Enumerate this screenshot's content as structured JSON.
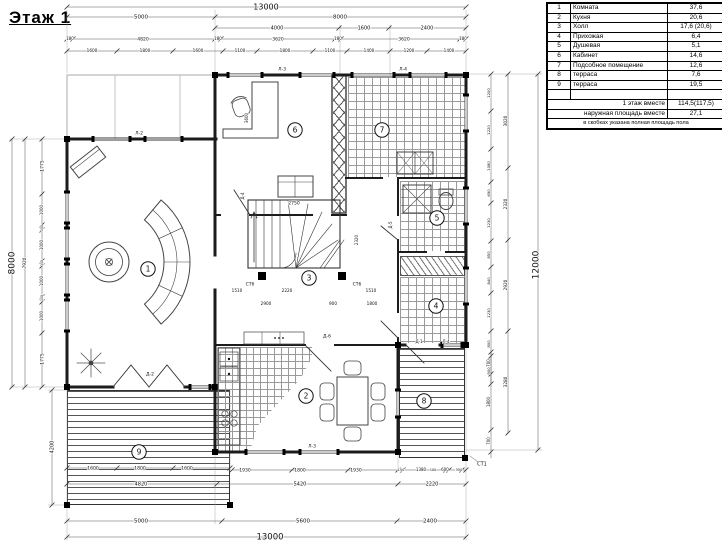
{
  "title": "Этаж 1",
  "legend": {
    "rows": [
      {
        "num": "1",
        "name": "Комната",
        "area": "37,6"
      },
      {
        "num": "2",
        "name": "Кухня",
        "area": "20,6"
      },
      {
        "num": "3",
        "name": "Холл",
        "area": "17,6 (20,6)"
      },
      {
        "num": "4",
        "name": "Прихожая",
        "area": "6,4"
      },
      {
        "num": "5",
        "name": "Душевая",
        "area": "5,1"
      },
      {
        "num": "6",
        "name": "Кабинет",
        "area": "14,6"
      },
      {
        "num": "7",
        "name": "Подсобное помещение",
        "area": "12,6"
      },
      {
        "num": "8",
        "name": "терраса",
        "area": "7,6"
      },
      {
        "num": "9",
        "name": "терраса",
        "area": "19,5"
      }
    ],
    "summary": [
      {
        "label": "1 этаж вместе",
        "value": "114,5(117,5)"
      },
      {
        "label": "наружная площадь вместе",
        "value": "27,1"
      }
    ],
    "note": "в скобках указана полная площадь пола"
  },
  "rooms": [
    {
      "num": "1",
      "name": "Комната"
    },
    {
      "num": "2",
      "name": "Кухня"
    },
    {
      "num": "3",
      "name": "Холл"
    },
    {
      "num": "4",
      "name": "Прихожая"
    },
    {
      "num": "5",
      "name": "Душевая"
    },
    {
      "num": "6",
      "name": "Кабинет"
    },
    {
      "num": "7",
      "name": "Подсобное помещение"
    },
    {
      "num": "8",
      "name": "терраса"
    },
    {
      "num": "9",
      "name": "терраса"
    }
  ],
  "dimensions": {
    "top": {
      "row1": "13000",
      "row2": [
        "5000",
        "8000"
      ],
      "row3": [
        "4000",
        "1600",
        "2400"
      ],
      "row4": [
        "180",
        "4820",
        "180",
        "3620",
        "180",
        "3620",
        "180"
      ],
      "row5": [
        "1600",
        "1800",
        "1600",
        "1100",
        "1800",
        "1100",
        "1400",
        "1200",
        "1400"
      ]
    },
    "bottom": {
      "row1": [
        "1600",
        "1800",
        "1600",
        "1930",
        "1800",
        "1930",
        "150",
        "1380",
        "100",
        "600",
        "350"
      ],
      "row2": [
        "4820",
        "5420",
        "2220"
      ],
      "row3": [
        "5000",
        "5600",
        "2400"
      ],
      "row4": "13000"
    },
    "left": {
      "overall": "8000",
      "inner": "7920",
      "chain": [
        "1775",
        "1000",
        "150",
        "1000",
        "150",
        "1000",
        "150",
        "1000",
        "1775"
      ],
      "terrace": "4200"
    },
    "right": {
      "overall": "12000",
      "mid": [
        "3020",
        "2320",
        "2920",
        "3280"
      ],
      "chain": [
        "1200",
        "1220",
        "1080",
        "690",
        "1230",
        "850",
        "840",
        "1230",
        "800",
        "900"
      ],
      "terrace": [
        "700",
        "1800",
        "700"
      ]
    },
    "interior": [
      "2750",
      "1510",
      "2220",
      "1510",
      "2900",
      "900",
      "1800",
      "3600",
      "2320"
    ]
  },
  "tags": [
    "Л-2",
    "Л-3",
    "Л-4",
    "Л-3",
    "Л-4",
    "Д-1",
    "Д-2",
    "Д-4",
    "Д-5",
    "Д-6",
    "СТ6",
    "СТ6",
    "СТ1"
  ],
  "colors": {
    "wall": "#1c1c1c",
    "dim": "#555555",
    "text": "#111111",
    "hatch": "#9a9a9a",
    "bg": "#ffffff"
  }
}
